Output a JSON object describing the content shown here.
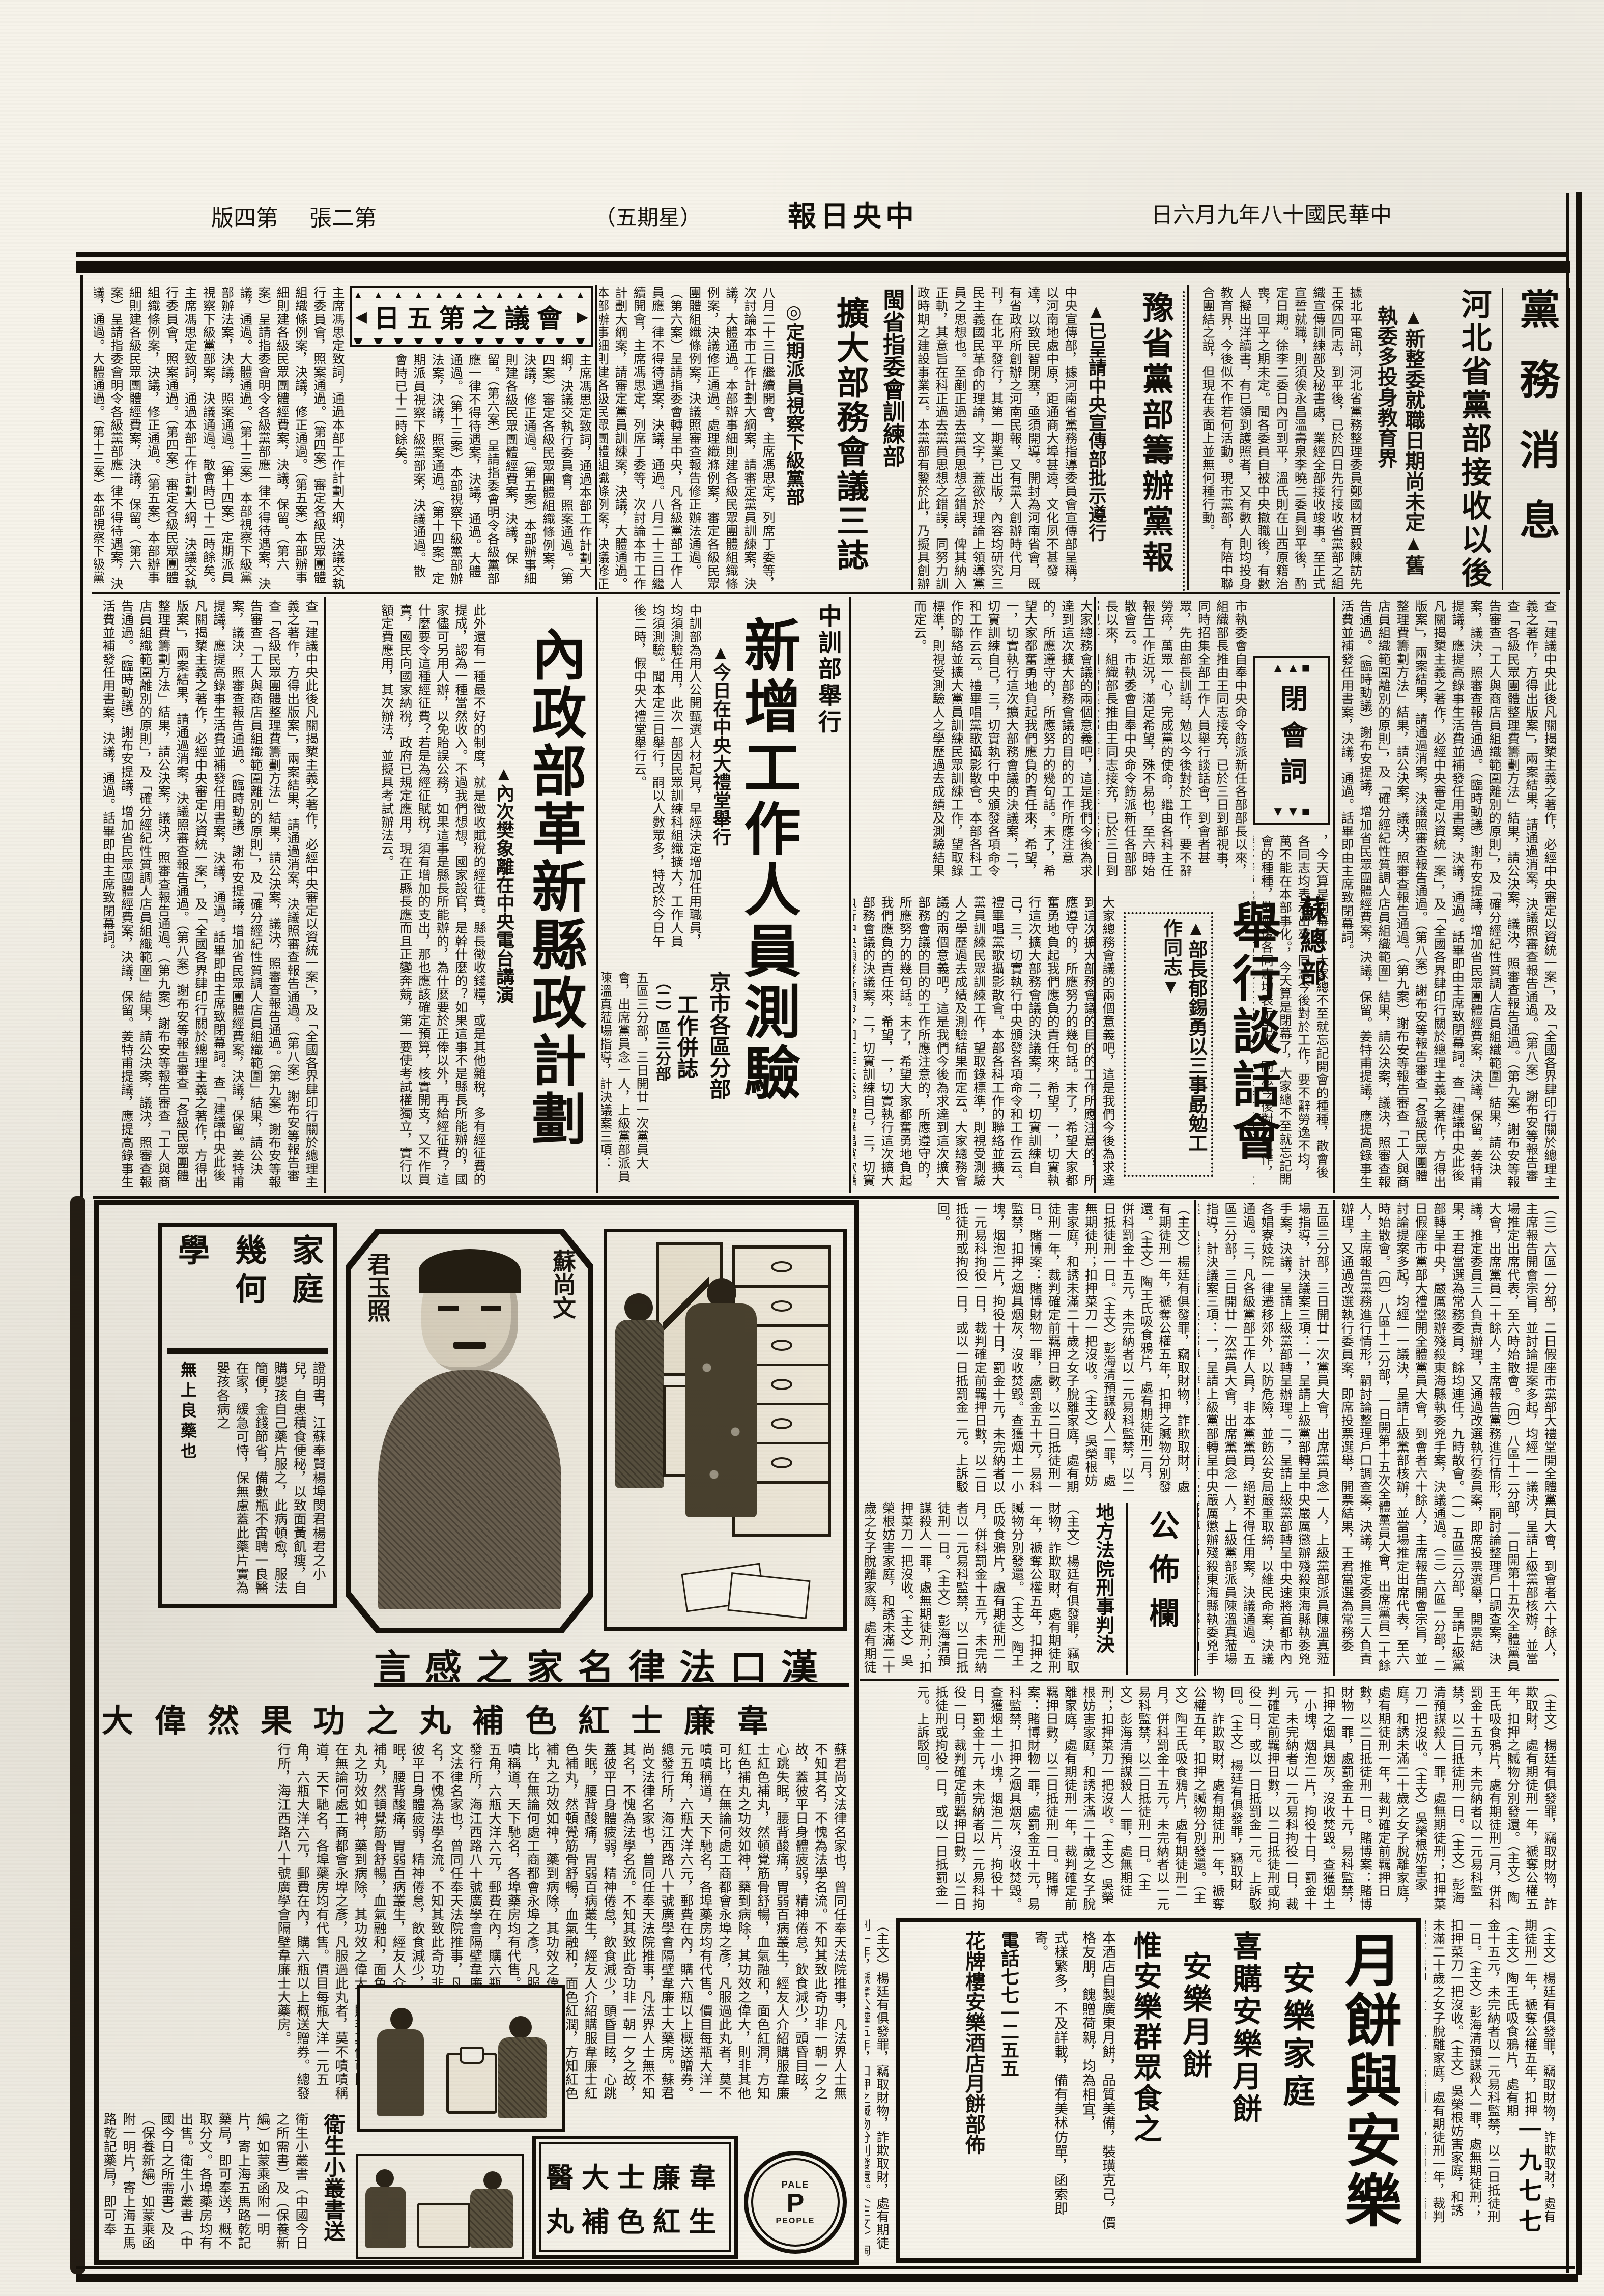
{
  "masthead": {
    "date": "中華民國十八年九月六日",
    "paper": "中央日報",
    "weekday_display": "（五期星）",
    "sheet": "第二張",
    "page": "第四版"
  },
  "section_party": {
    "label": "黨務消息"
  },
  "article_hebei": {
    "headline": "河北省黨部接收以後",
    "subhead1": "▲新整委就職日期尚未定",
    "subhead2": "▲舊執委多投身教育界",
    "body": "據北平電訊，河北省黨務整理委員鄭國材賈毅陳訪先王保四同志，到平後，已於四日先行接收省黨部之組織宣傳訓練部及秘書處，業經全部接收竣事。至正式宣誓就職，則須俟永昌溫壽泉李曉二委員到平後，酌定日期。徐李二委日內可到平，溫氏則在山西原籍治喪，回平之期未定。聞各委員自被中央撤職後，有數人擬出洋讀書，有已領到護照者，又有數人則均投身教育界，今後似不作若何活動。現市黨部，有陪中聯合團結之說，但現在表面上並無何種行動。"
  },
  "article_yu": {
    "headline": "豫省黨部籌辦黨報",
    "subhead": "▲已呈請中央宣傳部批示遵行",
    "body": "中央宣傳部，據河南省黨務指導委員會宣傳部呈稱，以河南地處中原，距通商大埠甚遠，文化夙不甚發達，以致民智閉塞，亟須開導。開封為河南省會，既有省政府所創辦之河南民報，又有黨人創辦時代月刊，在北平發行，其第一期業已出版，內容均研究三民主義國民革命的理論，文字，蓋欲於理論上領導黨員之思想也。至剷正過去黨員思想之錯誤，俾其納入正軌，其意旨在科正過去黨員思想之錯誤，同努力訓政時期之建設事業云。本黨部有鑒於此，乃擬具創辦河南民國日報計劃及預算書，呈請中央宣傳部批示准予開辦，一俟批准，即行着手籌備。"
  },
  "article_min": {
    "kicker": "閩省指委會訓練部",
    "headline": "擴大部務會議三誌",
    "subhead": "◎定期派員視察下級黨部",
    "body": "八月二十三日繼續開會，主席馮思定，列席丁委等，次討論本市工作計劃大綱案，請審定黨員訓練案，決議，大體通過。本部辦事細則建各級民眾團體組織條例案，決議修正通過。處理織滌例案，審定各級民眾團體組織條例案，決議照審查報告修正辦法通過。（第六案）呈請指委會轉呈中央，凡各級黨部工作人員應一律不得待遇案，決議，通過。"
  },
  "meeting5": {
    "box_label": "會議之第五日",
    "deco_top": "▲▲▲▲▲▲▲▲▲▲▲▲",
    "deco_bottom": "▼▼▼▼▼▼▼▼▼▼▼▼",
    "arrow_left": "◀",
    "arrow_right": "▶",
    "body": "主席馮思定致詞，通過本部工作計劃大綱，決議交執行委員會，照案通過。（第四案）審定各級民眾團體組織條例案，決議，修正通過。（第五案）本部辦事細則建各級民眾團體經費案，決議，保留。（第六案）呈請指委會明令各級黨部應一律不得待遇案，決議，通過。大體通過。（第十三案）本部視察下級黨部辦法案，決議，照案通過。（第十四案）定期派員視察下級黨部案，決議通過。散會時已十二時餘矣。"
  },
  "band2_right": {
    "body": "查「建議中央此後凡關揭櫫主義之著作，必經中央審定以資統一案」，及「全國各界肆印行關於總理主義之著作，方得出版案」，兩案結果，請通過消案，決議照審查報告通過。（第八案）謝布安等報告審查「各級民眾團體整理費籌劃方法」結果，請公決案，議決，照審查報告通過。（第九案）謝布安等報告審查「工人與商店員組織範圍離別的原則」，及「確分經紀性質調人店員組織範圍」結果，請公決案，議決，照審查報告通過。（臨時動議）謝布安提議，增加省民眾團體經費案，決議，保留。姜特甫提議，應提高錄事生活費並補發任用書案，決議，通過。話畢即由主席致閉幕詞。",
    "closing": "，今天算是閉幕了，大家總不至就忘記開會的種種，散會後各同志均表示出來。同志今後對於工作，要不辭勞逸不均，萬不能在本部事化。"
  },
  "closing_box": {
    "label": "閉會詞",
    "deco_top": "▲▲■",
    "deco_bottom": "▼▼■"
  },
  "filler_committee": "市執委會自奉中央命令飭派新任各部部長以來，組織部長推由王同志接充，已於三日到部視事，同時招集全部工作人員舉行談話會，到會者甚眾，先由部長訓話，勉以今後對於工作，要不辭勞瘁，萬眾一心，完成黨的使命，繼由各科主任報告工作近況，滿足希望，殊不易也，至六時始散會云。",
  "article_su": {
    "kicker": "蘇總部",
    "headline": "舉行談話會",
    "subhead1": "▲部長郁錫勇以三",
    "subhead2": "事勗勉工作同志▼",
    "body": "大家總務會議的兩個意義吧，這是我們今後為求達到這次擴大部務會議的目的的工作所應注意的，所應遵守的，所應努力的幾句話。末了，希望大家都奮勇地負起我們應負的責任來，希望，一，切實執行這次擴大部務會議的決議案，二，切實訓練自己，三，切實執行中央頒發各項命令和工作云云。禮畢唱黨歌攝影散會。本部各科工作的聯絡並擴大黨員訓練民眾訓練工作，望取錄標準，則視受測驗人之學歷過去成績及測驗結果而定云。"
  },
  "article_training": {
    "kicker": "中訓部舉行",
    "headline": "新增工作人員測驗",
    "subhead": "▲今日在中央大禮堂舉行",
    "body": "中訓部為用人公開甄選人材起見，早經決定增加任用職員，均須測驗任用，此次一部因民眾訓練科組織擴大，工作人員均須測驗。聞本定三日舉行，嗣以人數眾多，特改於今日午後二時，假中央大禮堂舉行云。"
  },
  "article_interior": {
    "headline": "內政部革新縣政計劃",
    "subhead": "▲內次樊象離在中央電台講演",
    "body": "此外還有一種最不好的制度，就是徵收賦稅的經征費。縣長徵收錢糧，或是其他雜稅，多有經征費的提成，認為一種當然收入。不過我們想想，國家設官，是幹什麼的？如果這事不是縣長所能辦的，國家儘可另用人辦，以免貽誤公務，如果這事是縣長所能辦的，為什麼要於正俸以外，再給經征費？這什麼要令這種經征費？若是為經征賦稅，須有增加的支出，那也應該確定預算，核實開支，又不作買賣，國民向國家納稅，政府已規定應用，現在正縣長應而且正變奔競，第一要使考試權獨立，實行以額定費應用，其次辦法，並擬具考試辦法云。"
  },
  "city_branches": {
    "title1": "京市各區分部",
    "title2": "工作併誌",
    "marker": "（二）區三分部",
    "body": "五區三分部，三日開廿一次黨員大會，出席黨員念一人，上級黨部派員陳溫真蒞場指導，計決議案三項：一，呈請上級黨部轉呈中央嚴厲懲辦殘殺東海縣執委兇手案，決議，呈請上級黨部轉呈辦理。二，呈請上級黨部轉呈中央速將首都市內各娼寮妓院一律遷移郊外，以防危險，並飭公安局嚴重取締，以維民命案，決議通過。三，凡各級黨部工作人員，非本黨黨員，絕對不得任用案，決議通過。"
  },
  "branch_reports": {
    "body": "（三）六區一分部，二日假座市黨部大禮堂開全體黨員大會，到會者六十餘人，主席報告開會宗旨，並討論提案多起，均經一一議決，呈請上級黨部核辦，並當場推定出席代表，至六時始散會。（四）八區十二分部，一日開第十五次全體黨員大會，出席黨員二十餘人，主席報告黨務進行情形，嗣討論整理戶口調查案，決議，推定委員三人負責辦理，又通過改選執行委員案，即席投票選舉，開票結果，王君當選為常務委員，餘均連任，九時散會。（一）五區三分部，呈請上級黨部轉呈中央，嚴厲懲辦殘殺東海縣執委兇手案，決議通過。"
  },
  "bulletin": {
    "label": "公佈欄"
  },
  "court": {
    "label": "地方法院刑事判決",
    "body": "（主文）楊廷有俱發罪，竊取財物，詐欺取財，處有期徒刑一年，褫奪公權五年，扣押之贓物分別發還。（主文）陶王氏吸食鴉片，處有期徒刑二月，併科罰金十五元，未完納者以一元易科監禁，以二日抵徒刑一日。（主文）彭海清預謀殺人一罪，處無期徒刑；扣押菜刀一把沒收。（主文）吳榮根妨害家庭，和誘未滿二十歲之女子脫離家庭，處有期徒刑一年，裁判確定前羈押日數，以二日抵徒刑一日。賭博案：賭博財物一罪，處罰金五十元，易科監禁，扣押之烟具烟灰，沒收焚毀。查獲烟土一小塊，烟泡二片，拘役十日，罰金十元，未完納者以一元易科拘役一日，裁判確定前羈押日數，以二日抵徒刑或拘役一日，或以一日抵罰金一元。上訴駁回。",
    "corner_numbers": "一九七七"
  },
  "ad_geometry": {
    "title_col1": "家庭",
    "title_col2": "幾何",
    "title_col3": "學",
    "body": "證明書，江蘇奉賢楊埠閔君楊君之小兒，自患積食便秘，以致面黃飢瘦，自購嬰孩自己藥片服之，此病頓愈，服法簡便，金錢節省，備數瓶不啻聘一良醫在家，緩急可恃，保無慮蓋此藥片實為嬰孩各病之",
    "tail": "無上良藥也"
  },
  "ad_pills": {
    "portrait_label_right": "蘇尚文",
    "portrait_label_left": "君玉照",
    "headline": "漢口法律名家之感言",
    "subhead": "韋廉士紅色補丸之功果然偉大",
    "body": "蘇君尚文法律名家也，曾同任奉天法院推事，凡法界人士無不知其名，不愧為法學名流。不知其致此奇功非一朝一夕之故，蓋彼平日身體疲弱，精神倦怠，飲食減少，頭昏目眩，心跳失眠，腰背酸痛，胃弱百病叢生，經友人介紹購服韋廉士紅色補丸，然頓覺筋骨舒暢，血氣融和，面色紅潤，方知紅色補丸之功效如神，藥到病除，其功效之偉大，則非其他可比，在無論何處工商都會永埠之彥，凡服過此丸者，莫不嘖嘖稱道，天下馳名，各埠藥房均有代售。價目每瓶大洋一元五角，六瓶大洋六元，郵費在內，購六瓶以上概送贈券。總發行所，海江西路八十號廣學會隔壁韋廉士大藥房。",
    "body2": "衛生小叢書（中國今日之所需書）及（保養新編）如蒙乘函附一明片，寄上海五馬路乾記藥局，即可奉送，概不取分文。各埠藥房均有出售。",
    "booklet_label": "衛生小叢書送",
    "brand_line1": "韋廉士大醫",
    "brand_line2": "生紅色補丸",
    "logo_top": "PALE",
    "logo_mid": "P",
    "logo_bottom": "PEOPLE"
  },
  "ad_mooncake": {
    "big": "月餅與安樂",
    "side": "安樂家庭",
    "line1": "喜購安樂月餅",
    "line2": "安樂月餅",
    "line3": "惟安樂群眾食之",
    "body1": "本酒店自製廣東月餅，品質美備，裝璜克己，價格友朋，餽贈荷親，均為相宜，",
    "body2": "式樣繁多，不及詳載，備有美秫仿單，函索即寄。",
    "phone": "電話七七一二五五",
    "sign": "花牌樓安樂酒店月餅部佈"
  }
}
